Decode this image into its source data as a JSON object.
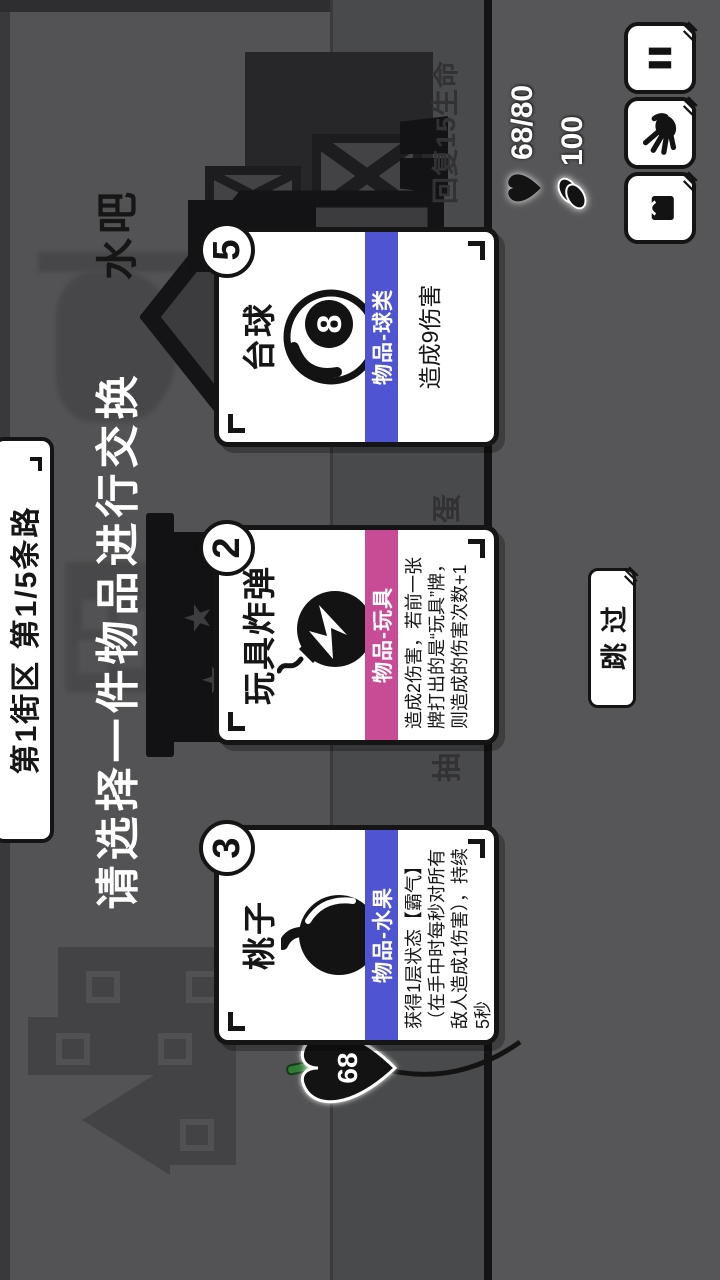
{
  "header": {
    "street_badge": "第1街区 第1/5条路",
    "prompt": "请选择一件物品进行交换"
  },
  "shop": {
    "name": "水吧",
    "heal_sign": "回复15生命",
    "gacha_sign_first": "抽",
    "gacha_sign_2": "一",
    "gacha_sign_3": "次",
    "gacha_sign_4": "扭",
    "gacha_sign_last": "蛋"
  },
  "cards": [
    {
      "cost": "3",
      "title": "桃子",
      "type": "物品-水果",
      "type_color": "#4e54d2",
      "icon": "peach-icon",
      "desc": "获得1层状态【霸气】（在手中时每秒对所有敌人造成1伤害），持续5秒"
    },
    {
      "cost": "2",
      "title": "玩具炸弹",
      "type": "物品-玩具",
      "type_color": "#c84b95",
      "icon": "bomb-icon",
      "desc": "造成2伤害，若前一张牌打出的是“玩具”牌，则造成的伤害次数+1"
    },
    {
      "cost": "5",
      "title": "台球",
      "type": "物品-球类",
      "type_color": "#4e54d2",
      "icon": "eight-ball-icon",
      "ball_number": "8",
      "desc": "造成9伤害"
    }
  ],
  "hud": {
    "hp": "68/80",
    "coins": "100",
    "player_hp": "68"
  },
  "actions": {
    "skip": "跳过"
  }
}
